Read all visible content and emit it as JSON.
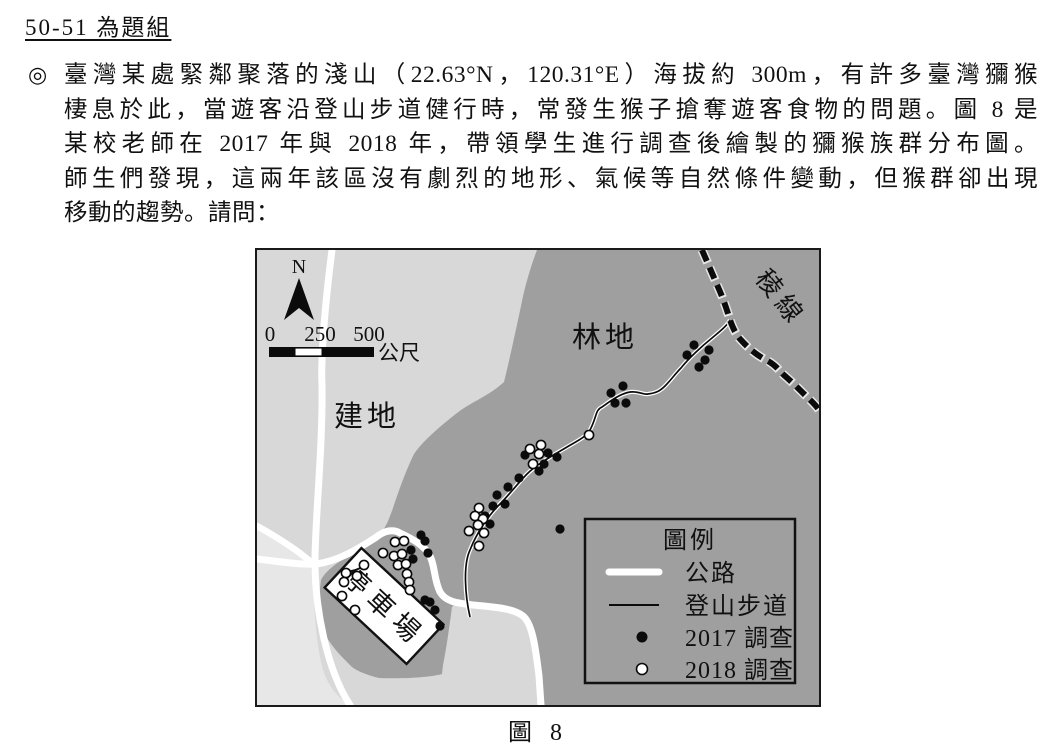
{
  "heading": {
    "text": "50-51 為題組"
  },
  "paragraph": {
    "marker": "◎",
    "lines": [
      "臺灣某處緊鄰聚落的淺山（22.63°N，120.31°E）海拔約 300m，有許多臺灣獼猴",
      "棲息於此，當遊客沿登山步道健行時，常發生猴子搶奪遊客食物的問題。圖 8 是",
      "某校老師在 2017 年與 2018 年，帶領學生進行調查後繪製的獼猴族群分布圖。",
      "師生們發現，這兩年該區沒有劇烈的地形、氣候等自然條件變動，但猴群卻出現",
      "移動的趨勢。請問："
    ]
  },
  "figure": {
    "caption": "圖 8",
    "map": {
      "labels": {
        "north": "N",
        "forest": "林地",
        "built": "建地",
        "ridge": "稜線",
        "parking": "停車場"
      },
      "scalebar": {
        "tick0": "0",
        "tick1": "250",
        "tick2": "500",
        "unit": "公尺"
      },
      "legend": {
        "title": "圖例",
        "items": [
          {
            "symbol": "road",
            "label": "公路"
          },
          {
            "symbol": "trail",
            "label": "登山步道"
          },
          {
            "symbol": "dot-black",
            "label": "2017 調查"
          },
          {
            "symbol": "dot-white",
            "label": "2018 調查"
          }
        ]
      },
      "colors": {
        "forest": "#9f9f9f",
        "built": "#d8d8d8",
        "outer_light": "#e7e7e7",
        "road": "#ffffff",
        "ink": "#111111"
      },
      "survey_2017_points": [
        [
          437,
          95
        ],
        [
          430,
          105
        ],
        [
          452,
          100
        ],
        [
          448,
          110
        ],
        [
          442,
          117
        ],
        [
          354,
          143
        ],
        [
          366,
          136
        ],
        [
          358,
          153
        ],
        [
          369,
          153
        ],
        [
          268,
          205
        ],
        [
          291,
          203
        ],
        [
          300,
          207
        ],
        [
          287,
          214
        ],
        [
          282,
          221
        ],
        [
          262,
          228
        ],
        [
          251,
          237
        ],
        [
          240,
          245
        ],
        [
          248,
          254
        ],
        [
          236,
          256
        ],
        [
          228,
          266
        ],
        [
          233,
          274
        ],
        [
          303,
          279
        ],
        [
          164,
          285
        ],
        [
          168,
          291
        ],
        [
          171,
          303
        ],
        [
          154,
          300
        ],
        [
          156,
          309
        ],
        [
          168,
          350
        ],
        [
          173,
          352
        ],
        [
          178,
          360
        ],
        [
          183,
          376
        ]
      ],
      "survey_2018_points": [
        [
          273,
          199
        ],
        [
          284,
          195
        ],
        [
          282,
          204
        ],
        [
          276,
          214
        ],
        [
          332,
          185
        ],
        [
          222,
          258
        ],
        [
          218,
          266
        ],
        [
          226,
          269
        ],
        [
          221,
          275
        ],
        [
          212,
          281
        ],
        [
          227,
          283
        ],
        [
          222,
          296
        ],
        [
          138,
          292
        ],
        [
          147,
          291
        ],
        [
          126,
          303
        ],
        [
          137,
          306
        ],
        [
          145,
          304
        ],
        [
          141,
          315
        ],
        [
          149,
          314
        ],
        [
          107,
          315
        ],
        [
          100,
          326
        ],
        [
          89,
          323
        ],
        [
          87,
          332
        ],
        [
          85,
          346
        ],
        [
          98,
          360
        ],
        [
          150,
          324
        ],
        [
          152,
          332
        ],
        [
          153,
          340
        ]
      ]
    }
  }
}
